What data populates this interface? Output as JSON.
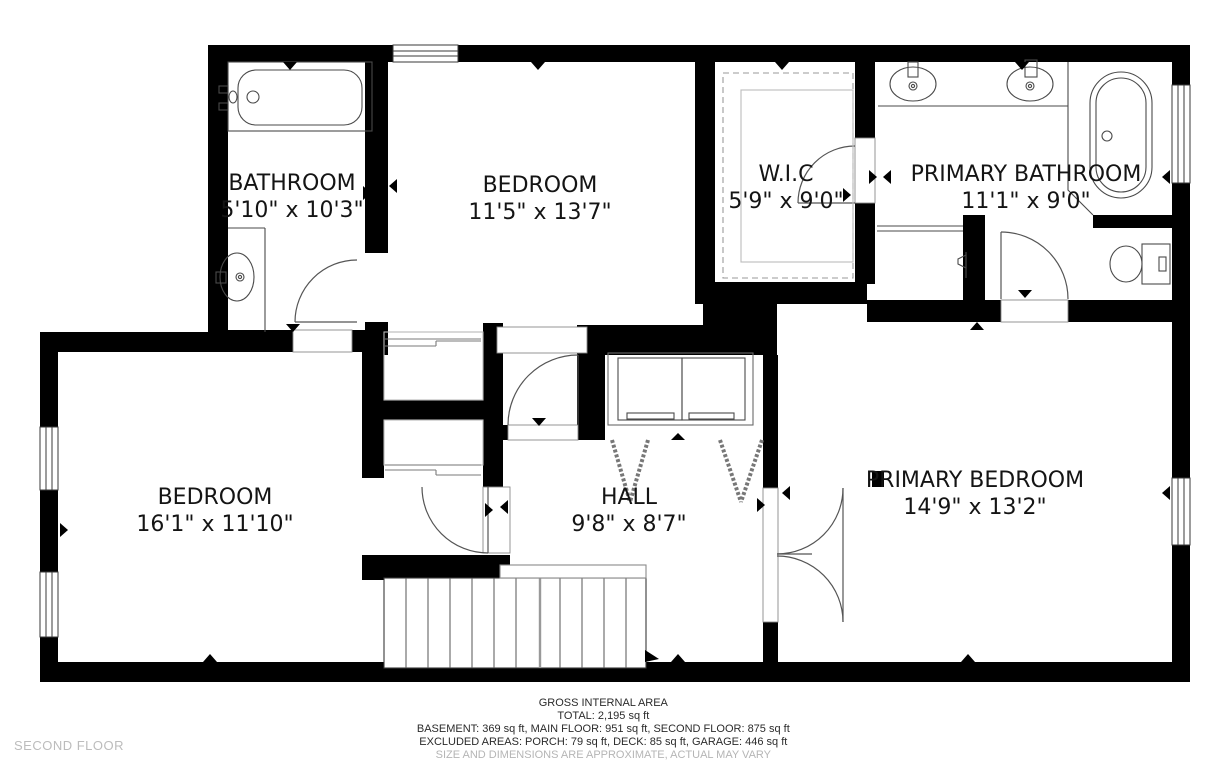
{
  "floor_label": "SECOND FLOOR",
  "rooms": [
    {
      "name": "BATHROOM",
      "dims": "5'10\" x 10'3\""
    },
    {
      "name": "BEDROOM",
      "dims": "11'5\" x 13'7\""
    },
    {
      "name": "W.I.C",
      "dims": "5'9\" x 9'0\""
    },
    {
      "name": "PRIMARY BATHROOM",
      "dims": "11'1\" x 9'0\""
    },
    {
      "name": "BEDROOM",
      "dims": "16'1\" x 11'10\""
    },
    {
      "name": "HALL",
      "dims": "9'8\" x 8'7\""
    },
    {
      "name": "PRIMARY BEDROOM",
      "dims": "14'9\" x 13'2\""
    }
  ],
  "footer": {
    "title": "GROSS INTERNAL AREA",
    "total": "TOTAL: 2,195 sq ft",
    "floors": "BASEMENT: 369 sq ft, MAIN FLOOR: 951 sq ft, SECOND FLOOR: 875 sq ft",
    "excluded": "EXCLUDED AREAS: PORCH: 79 sq ft, DECK: 85 sq ft, GARAGE: 446 sq ft",
    "disclaimer": "SIZE AND DIMENSIONS ARE APPROXIMATE, ACTUAL MAY VARY"
  },
  "colors": {
    "wall": "#000000",
    "fixture_line": "#4a4a4a",
    "light_line": "#9a9a9a",
    "muted_text": "#b5b5b5"
  }
}
